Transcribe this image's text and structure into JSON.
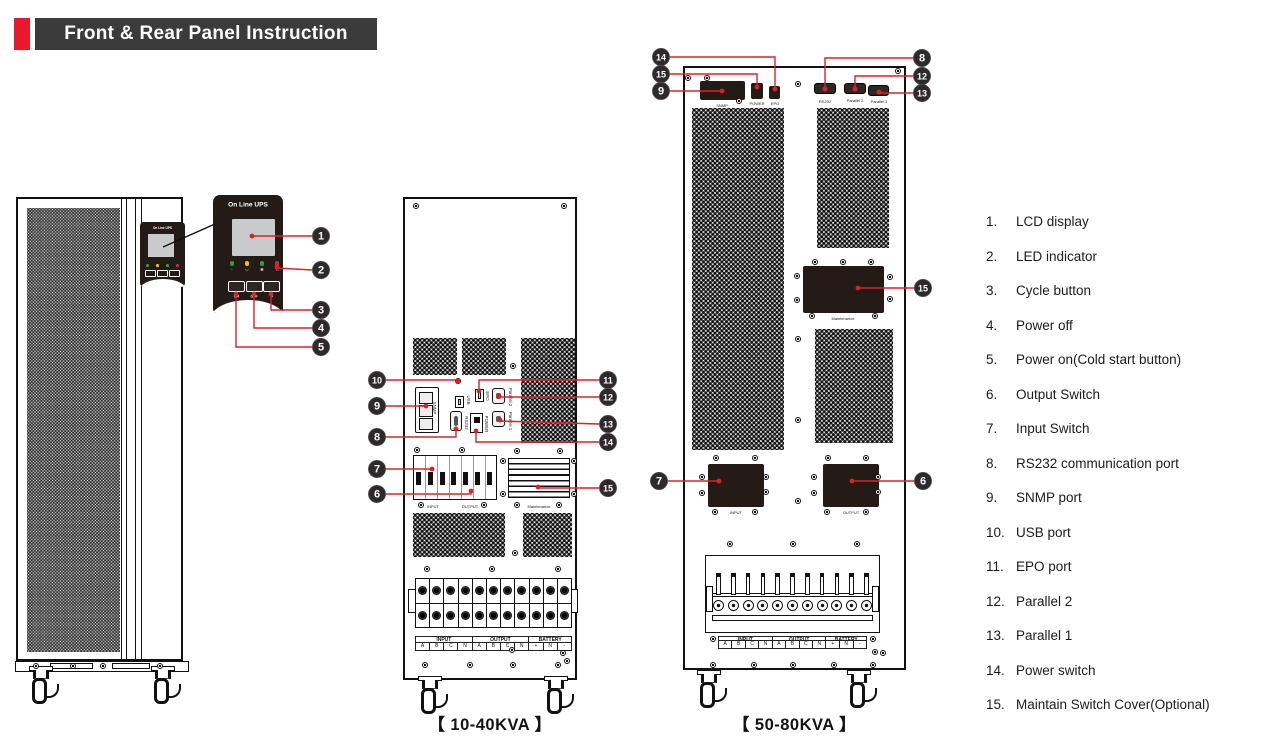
{
  "header": {
    "title": "Front & Rear Panel Instruction"
  },
  "colors": {
    "accent_red": "#e8192d",
    "header_bar": "#3b3b3b",
    "panel_black": "#241a16",
    "callout_line": "#d8232a",
    "callout_circle": "#2e2a2b",
    "lcd_gray": "#c9cacb",
    "led_green": "#2f9e41",
    "led_yellow": "#efc31c",
    "led_red": "#e02529"
  },
  "front_view": {
    "brand": "On Line UPS"
  },
  "detail_panel": {
    "brand": "On Line UPS",
    "buttons": [
      "ON",
      "OFF",
      "↵"
    ],
    "leds": [
      {
        "name": "ac-led",
        "hex": "#2f9e41",
        "glyph": "~"
      },
      {
        "name": "battery-led",
        "hex": "#efc31c",
        "glyph": "▭"
      },
      {
        "name": "bypass-led",
        "hex": "#2f9e41",
        "glyph": "▣"
      },
      {
        "name": "alarm-led",
        "hex": "#e02529",
        "glyph": "△"
      }
    ]
  },
  "rear_10_40": {
    "caption": "【 10-40KVA 】",
    "labels": {
      "snmp": "SNMP",
      "usb": "USB",
      "rs232": "RS232",
      "epo": "EPO",
      "parallel2": "Parallel 2",
      "power": "POWER",
      "parallel1": "Parallel 1",
      "input": "INPUT",
      "output": "OUTPUT",
      "maintenance": "Maintenance"
    }
  },
  "rear_50_80": {
    "caption": "【 50-80KVA 】",
    "labels": {
      "snmp": "SNMP",
      "power": "POWER",
      "epo": "EPO",
      "rs232": "RS232",
      "parallel2": "Parallel 2",
      "parallel1": "Parallel 1",
      "input": "INPUT",
      "output": "OUTPUT",
      "maintenance": "Maintenance"
    }
  },
  "terminal_strip": {
    "groups": [
      {
        "name": "INPUT",
        "cells": [
          "A",
          "B",
          "C",
          "N"
        ]
      },
      {
        "name": "OUTPUT",
        "cells": [
          "A",
          "B",
          "C",
          "N"
        ]
      },
      {
        "name": "BATTERY",
        "cells": [
          "+",
          "N",
          "-"
        ]
      }
    ]
  },
  "legend": {
    "items": [
      {
        "num": "1.",
        "label": "LCD display"
      },
      {
        "num": "2.",
        "label": "LED indicator"
      },
      {
        "num": "3.",
        "label": "Cycle button"
      },
      {
        "num": "4.",
        "label": "Power off"
      },
      {
        "num": "5.",
        "label": "Power on(Cold start button)"
      },
      {
        "num": "6.",
        "label": "Output Switch"
      },
      {
        "num": "7.",
        "label": "Input Switch"
      },
      {
        "num": "8.",
        "label": "RS232 communication port"
      },
      {
        "num": "9.",
        "label": "SNMP port"
      },
      {
        "num": "10.",
        "label": "USB port"
      },
      {
        "num": "11.",
        "label": "EPO port"
      },
      {
        "num": "12.",
        "label": "Parallel 2"
      },
      {
        "num": "13.",
        "label": "Parallel 1"
      },
      {
        "num": "14.",
        "label": "Power switch"
      },
      {
        "num": "15.",
        "label": "Maintain Switch Cover(Optional)"
      }
    ]
  },
  "annotations": {
    "pointer_line": [
      [
        163,
        247
      ],
      [
        215,
        224
      ]
    ]
  },
  "callouts": [
    {
      "n": "1",
      "c": [
        321,
        236
      ],
      "path": [
        [
          252,
          236
        ],
        [
          312,
          236
        ]
      ],
      "dot": [
        252,
        236
      ]
    },
    {
      "n": "2",
      "c": [
        321,
        270
      ],
      "path": [
        [
          277,
          268
        ],
        [
          312,
          270
        ]
      ],
      "dot": [
        277,
        267
      ]
    },
    {
      "n": "3",
      "c": [
        321,
        310
      ],
      "path": [
        [
          271,
          294
        ],
        [
          271,
          310
        ],
        [
          312,
          310
        ]
      ],
      "dot": [
        271,
        294
      ]
    },
    {
      "n": "4",
      "c": [
        321,
        328
      ],
      "path": [
        [
          254,
          294
        ],
        [
          254,
          328
        ],
        [
          312,
          328
        ]
      ],
      "dot": [
        254,
        294
      ]
    },
    {
      "n": "5",
      "c": [
        321,
        347
      ],
      "path": [
        [
          236,
          294
        ],
        [
          236,
          347
        ],
        [
          312,
          347
        ]
      ],
      "dot": [
        236,
        294
      ]
    },
    {
      "n": "10",
      "c": [
        377,
        380
      ],
      "path": [
        [
          386,
          380
        ],
        [
          458,
          380
        ]
      ],
      "dot": [
        458,
        381
      ]
    },
    {
      "n": "9",
      "c": [
        377,
        406
      ],
      "path": [
        [
          386,
          406
        ],
        [
          426,
          406
        ]
      ],
      "dot": [
        426,
        406
      ]
    },
    {
      "n": "8",
      "c": [
        377,
        437
      ],
      "path": [
        [
          386,
          437
        ],
        [
          456,
          437
        ],
        [
          456,
          429
        ]
      ],
      "dot": [
        456,
        429
      ]
    },
    {
      "n": "7",
      "c": [
        377,
        469
      ],
      "path": [
        [
          386,
          469
        ],
        [
          432,
          469
        ]
      ],
      "dot": [
        432,
        469
      ]
    },
    {
      "n": "6",
      "c": [
        377,
        494
      ],
      "path": [
        [
          386,
          494
        ],
        [
          471,
          494
        ],
        [
          471,
          491
        ]
      ],
      "dot": [
        471,
        491
      ]
    },
    {
      "n": "11",
      "c": [
        608,
        380
      ],
      "path": [
        [
          599,
          380
        ],
        [
          479,
          380
        ],
        [
          479,
          391
        ]
      ],
      "dot": [
        479,
        391
      ]
    },
    {
      "n": "12",
      "c": [
        608,
        397
      ],
      "path": [
        [
          599,
          397
        ],
        [
          499,
          397
        ]
      ],
      "dot": [
        499,
        396
      ]
    },
    {
      "n": "13",
      "c": [
        608,
        424
      ],
      "path": [
        [
          599,
          424
        ],
        [
          500,
          421
        ]
      ],
      "dot": [
        500,
        420
      ]
    },
    {
      "n": "14",
      "c": [
        608,
        442
      ],
      "path": [
        [
          599,
          442
        ],
        [
          476,
          442
        ],
        [
          476,
          431
        ]
      ],
      "dot": [
        476,
        431
      ]
    },
    {
      "n": "15",
      "c": [
        608,
        488
      ],
      "path": [
        [
          599,
          488
        ],
        [
          538,
          488
        ]
      ],
      "dot": [
        538,
        487
      ]
    },
    {
      "n": "14",
      "c": [
        661,
        57
      ],
      "path": [
        [
          670,
          57
        ],
        [
          775,
          57
        ],
        [
          775,
          88
        ]
      ],
      "dot": [
        775,
        89
      ]
    },
    {
      "n": "15",
      "c": [
        661,
        74
      ],
      "path": [
        [
          670,
          74
        ],
        [
          757,
          74
        ],
        [
          757,
          86
        ]
      ],
      "dot": [
        757,
        87
      ]
    },
    {
      "n": "9",
      "c": [
        661,
        91
      ],
      "path": [
        [
          670,
          91
        ],
        [
          722,
          91
        ]
      ],
      "dot": [
        722,
        91
      ]
    },
    {
      "n": "7",
      "c": [
        659,
        481
      ],
      "path": [
        [
          668,
          481
        ],
        [
          719,
          481
        ]
      ],
      "dot": [
        719,
        481
      ]
    },
    {
      "n": "8",
      "c": [
        922,
        58
      ],
      "path": [
        [
          913,
          58
        ],
        [
          825,
          58
        ],
        [
          825,
          88
        ]
      ],
      "dot": [
        825,
        89
      ]
    },
    {
      "n": "12",
      "c": [
        922,
        76
      ],
      "path": [
        [
          913,
          76
        ],
        [
          855,
          76
        ],
        [
          855,
          88
        ]
      ],
      "dot": [
        855,
        89
      ]
    },
    {
      "n": "13",
      "c": [
        922,
        93
      ],
      "path": [
        [
          913,
          93
        ],
        [
          879,
          93
        ]
      ],
      "dot": [
        879,
        92
      ]
    },
    {
      "n": "15",
      "c": [
        923,
        288
      ],
      "path": [
        [
          914,
          288
        ],
        [
          858,
          288
        ]
      ],
      "dot": [
        858,
        288
      ]
    },
    {
      "n": "6",
      "c": [
        923,
        481
      ],
      "path": [
        [
          914,
          481
        ],
        [
          852,
          481
        ]
      ],
      "dot": [
        852,
        481
      ]
    }
  ]
}
